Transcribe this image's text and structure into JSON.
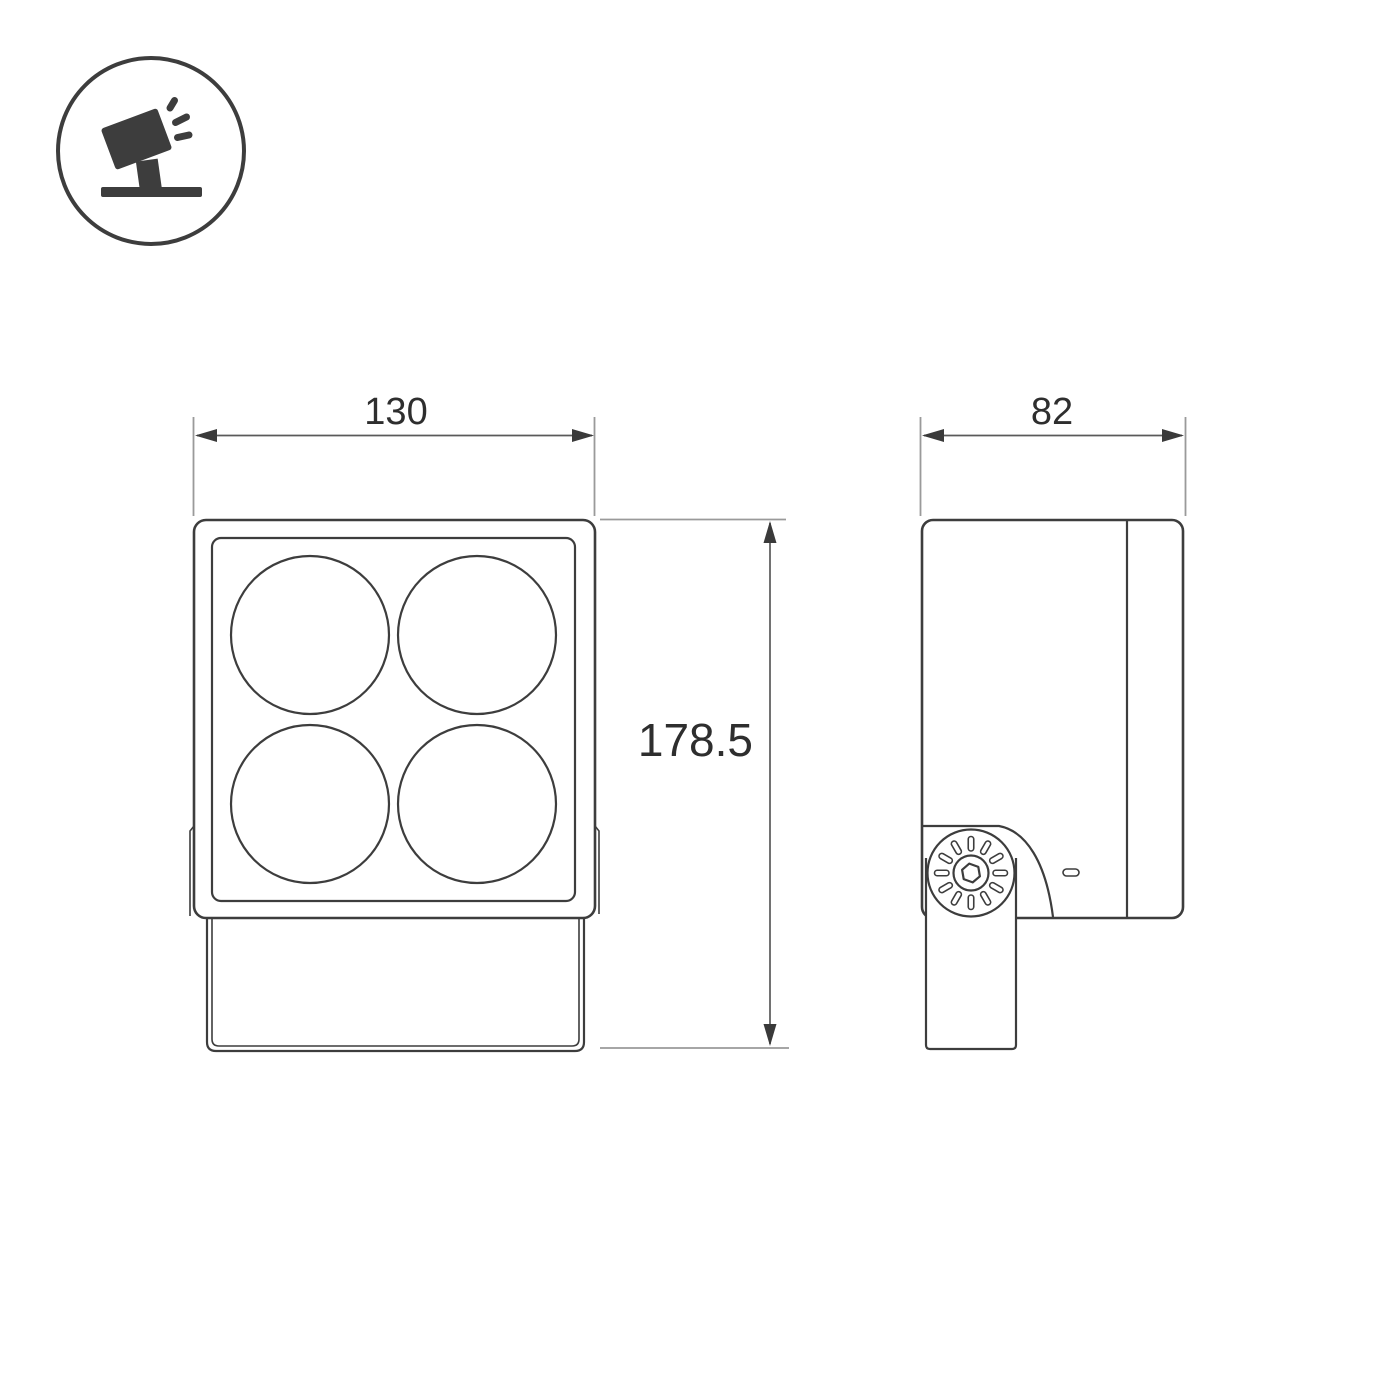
{
  "drawing_title": "floodlight-dimension-drawing",
  "legend_icon": {
    "name": "tilted-floodlight-icon"
  },
  "dimensions": {
    "front_width": "130",
    "overall_height": "178.5",
    "side_depth": "82"
  },
  "views": {
    "front": {
      "lens_count": 4
    },
    "side": {
      "knob_slot_count": 12
    }
  },
  "colors": {
    "outline": "#3d3d3d",
    "dimension_line": "#5a5a5a",
    "extension_line": "#9a9a9a",
    "arrowhead": "#3a3a3a",
    "text": "#2e2e2e",
    "background": "#ffffff"
  }
}
